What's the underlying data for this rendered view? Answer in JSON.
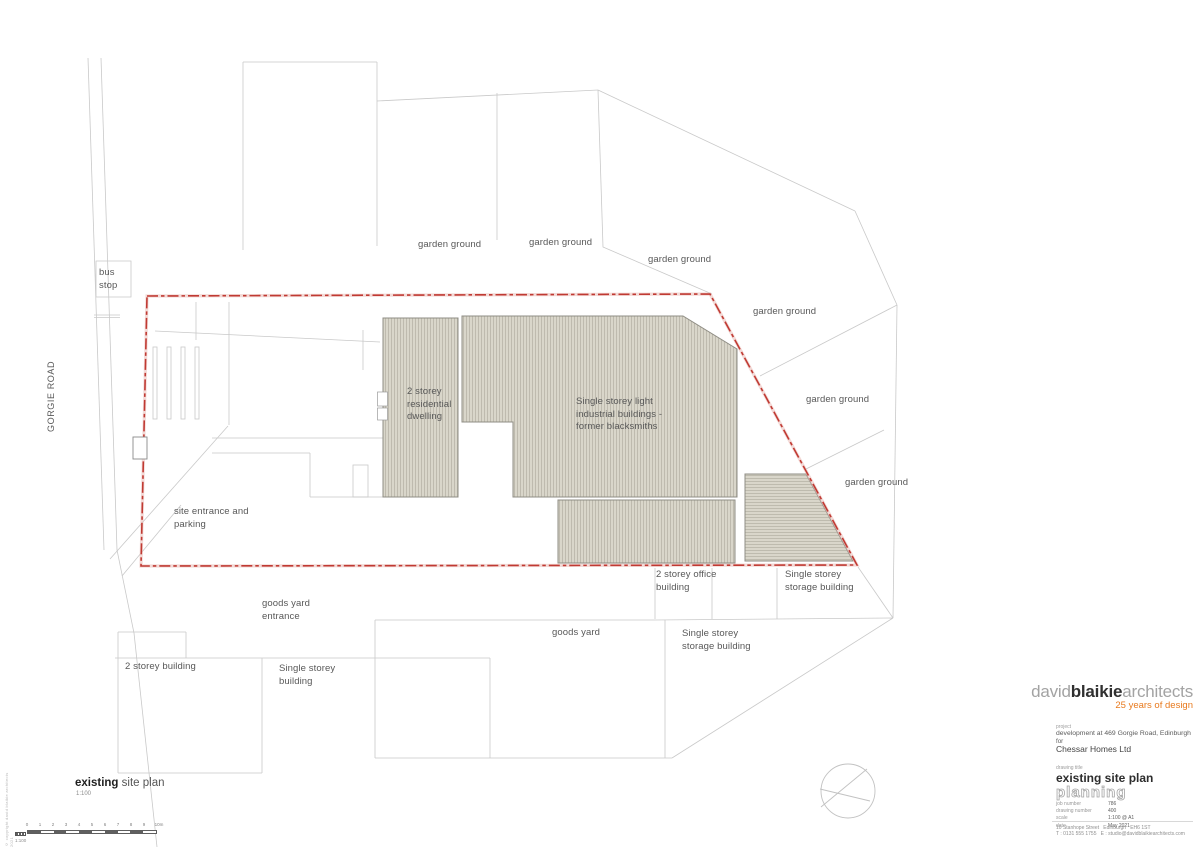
{
  "plan": {
    "road_label": "GORGIE ROAD",
    "bus_stop": "bus stop",
    "garden_ground": "garden ground",
    "labels": {
      "residential": "2 storey residential dwelling",
      "industrial": "Single storey light industrial buildings - former blacksmiths",
      "site_entrance": "site entrance and parking",
      "goods_yard_entrance": "goods yard entrance",
      "goods_yard": "goods yard",
      "office": "2 storey office building",
      "storage_right": "Single storey storage building",
      "storage_lower": "Single storey storage building",
      "two_storey_building": "2 storey building",
      "single_storey_building": "Single storey building"
    }
  },
  "drawing_caption": {
    "bold": "existing",
    "rest": " site plan",
    "scale": "1:100"
  },
  "scalebar": {
    "ticks": [
      "0",
      "1",
      "2",
      "3",
      "4",
      "5",
      "6",
      "7",
      "8",
      "9",
      "10m"
    ],
    "scale_label": "1:100"
  },
  "titleblock": {
    "firm_part1": "david",
    "firm_part2": "blaikie",
    "firm_part3": "architects",
    "tagline": "25 years of design",
    "project_label": "project",
    "project": "development at 469 Gorgie Road, Edinburgh",
    "for_label": "for",
    "client": "Chessar Homes Ltd",
    "drawing_title_label": "drawing title",
    "drawing_title": "existing site plan",
    "stage": "planning",
    "fields": [
      {
        "label": "job number",
        "value": "786"
      },
      {
        "label": "drawing number",
        "value": "400"
      },
      {
        "label": "scale",
        "value": "1:100 @ A1"
      },
      {
        "label": "date",
        "value": "May 2021"
      }
    ],
    "address": "10 Stanhope Street   Edinburgh   EH6 1ST",
    "contact": "T : 0131 555 1755   E : studio@davidblaikiearchitects.com"
  },
  "colors": {
    "boundary_red": "#c03a33",
    "tagline_orange": "#e87a1e",
    "building_fill": "#d9d6ca"
  },
  "footer": {
    "copyright": "© copyright david blaikie architects 2021"
  }
}
